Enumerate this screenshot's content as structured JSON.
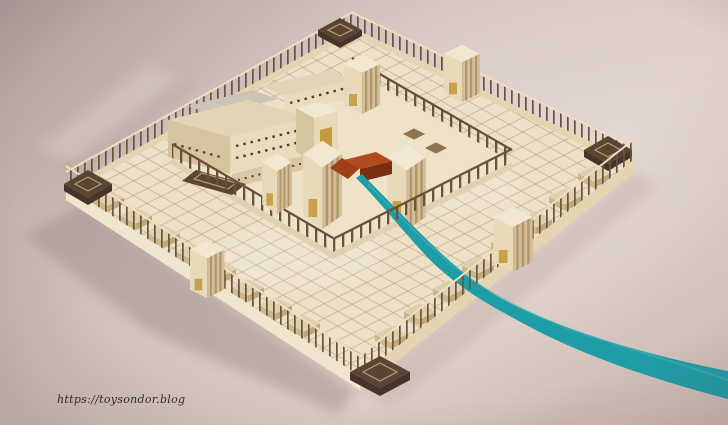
{
  "image": {
    "type": "3d-architectural-render",
    "subject": "Aerial isometric model of a square ancient temple complex (walled courts, colonnades, gate towers, corner chambers, central sanctuary and red altar) with a turquoise stream flowing from the altar out past the eastern wall and widening toward the lower right",
    "background": "soft pink-beige studio gradient"
  },
  "watermark": {
    "url": "https://toysondor.blog"
  },
  "colors": {
    "bg1": "#b0a1a0",
    "bg2": "#d3c2bc",
    "bg3": "#ddccc5",
    "bg4": "#cfbcb6",
    "highlight": "#ffffff",
    "platform": "#ece0c8",
    "platform_edge": "#f3ebd9",
    "wall": "#e5d4b2",
    "wall_bright": "#f0e6d0",
    "post": "#6a523c",
    "rail": "#ecdfc0",
    "slat": "#ab8f63",
    "court_grid": "#a08659",
    "inner_floor": "#eee2c8",
    "inner_edge": "#e0d2b1",
    "beam": "#6b4f38",
    "pad_top": "#decfaf",
    "pad_left": "#cdb78d",
    "pad_right": "#bfa87c",
    "tower_top": "#f2e8d2",
    "tower_light": "#e8dab9",
    "tower_dark": "#d4be97",
    "door": "#c49a3f",
    "corner": "#5a4434",
    "corner_face": "#46332a",
    "corner_line": "#bb9d71",
    "roof_gray": "#cdc4b6",
    "roof": "#e2d5b6",
    "temple_face": "#e9dbbc",
    "temple_side": "#d6c4a1",
    "wing": "#dac8a5",
    "window": "#503c28",
    "table_top": "#8f734c",
    "altar_top": "#b14a1f",
    "altar_side": "#7c2e11",
    "altar_ramp": "#9c4019",
    "stream": "#1f9da7",
    "stream_light": "#45b6bd",
    "shadow": "#a28e8b",
    "shadow_warm": "#b4a099",
    "light_band": "#d7c9c2",
    "text": "#2b2b2b"
  }
}
